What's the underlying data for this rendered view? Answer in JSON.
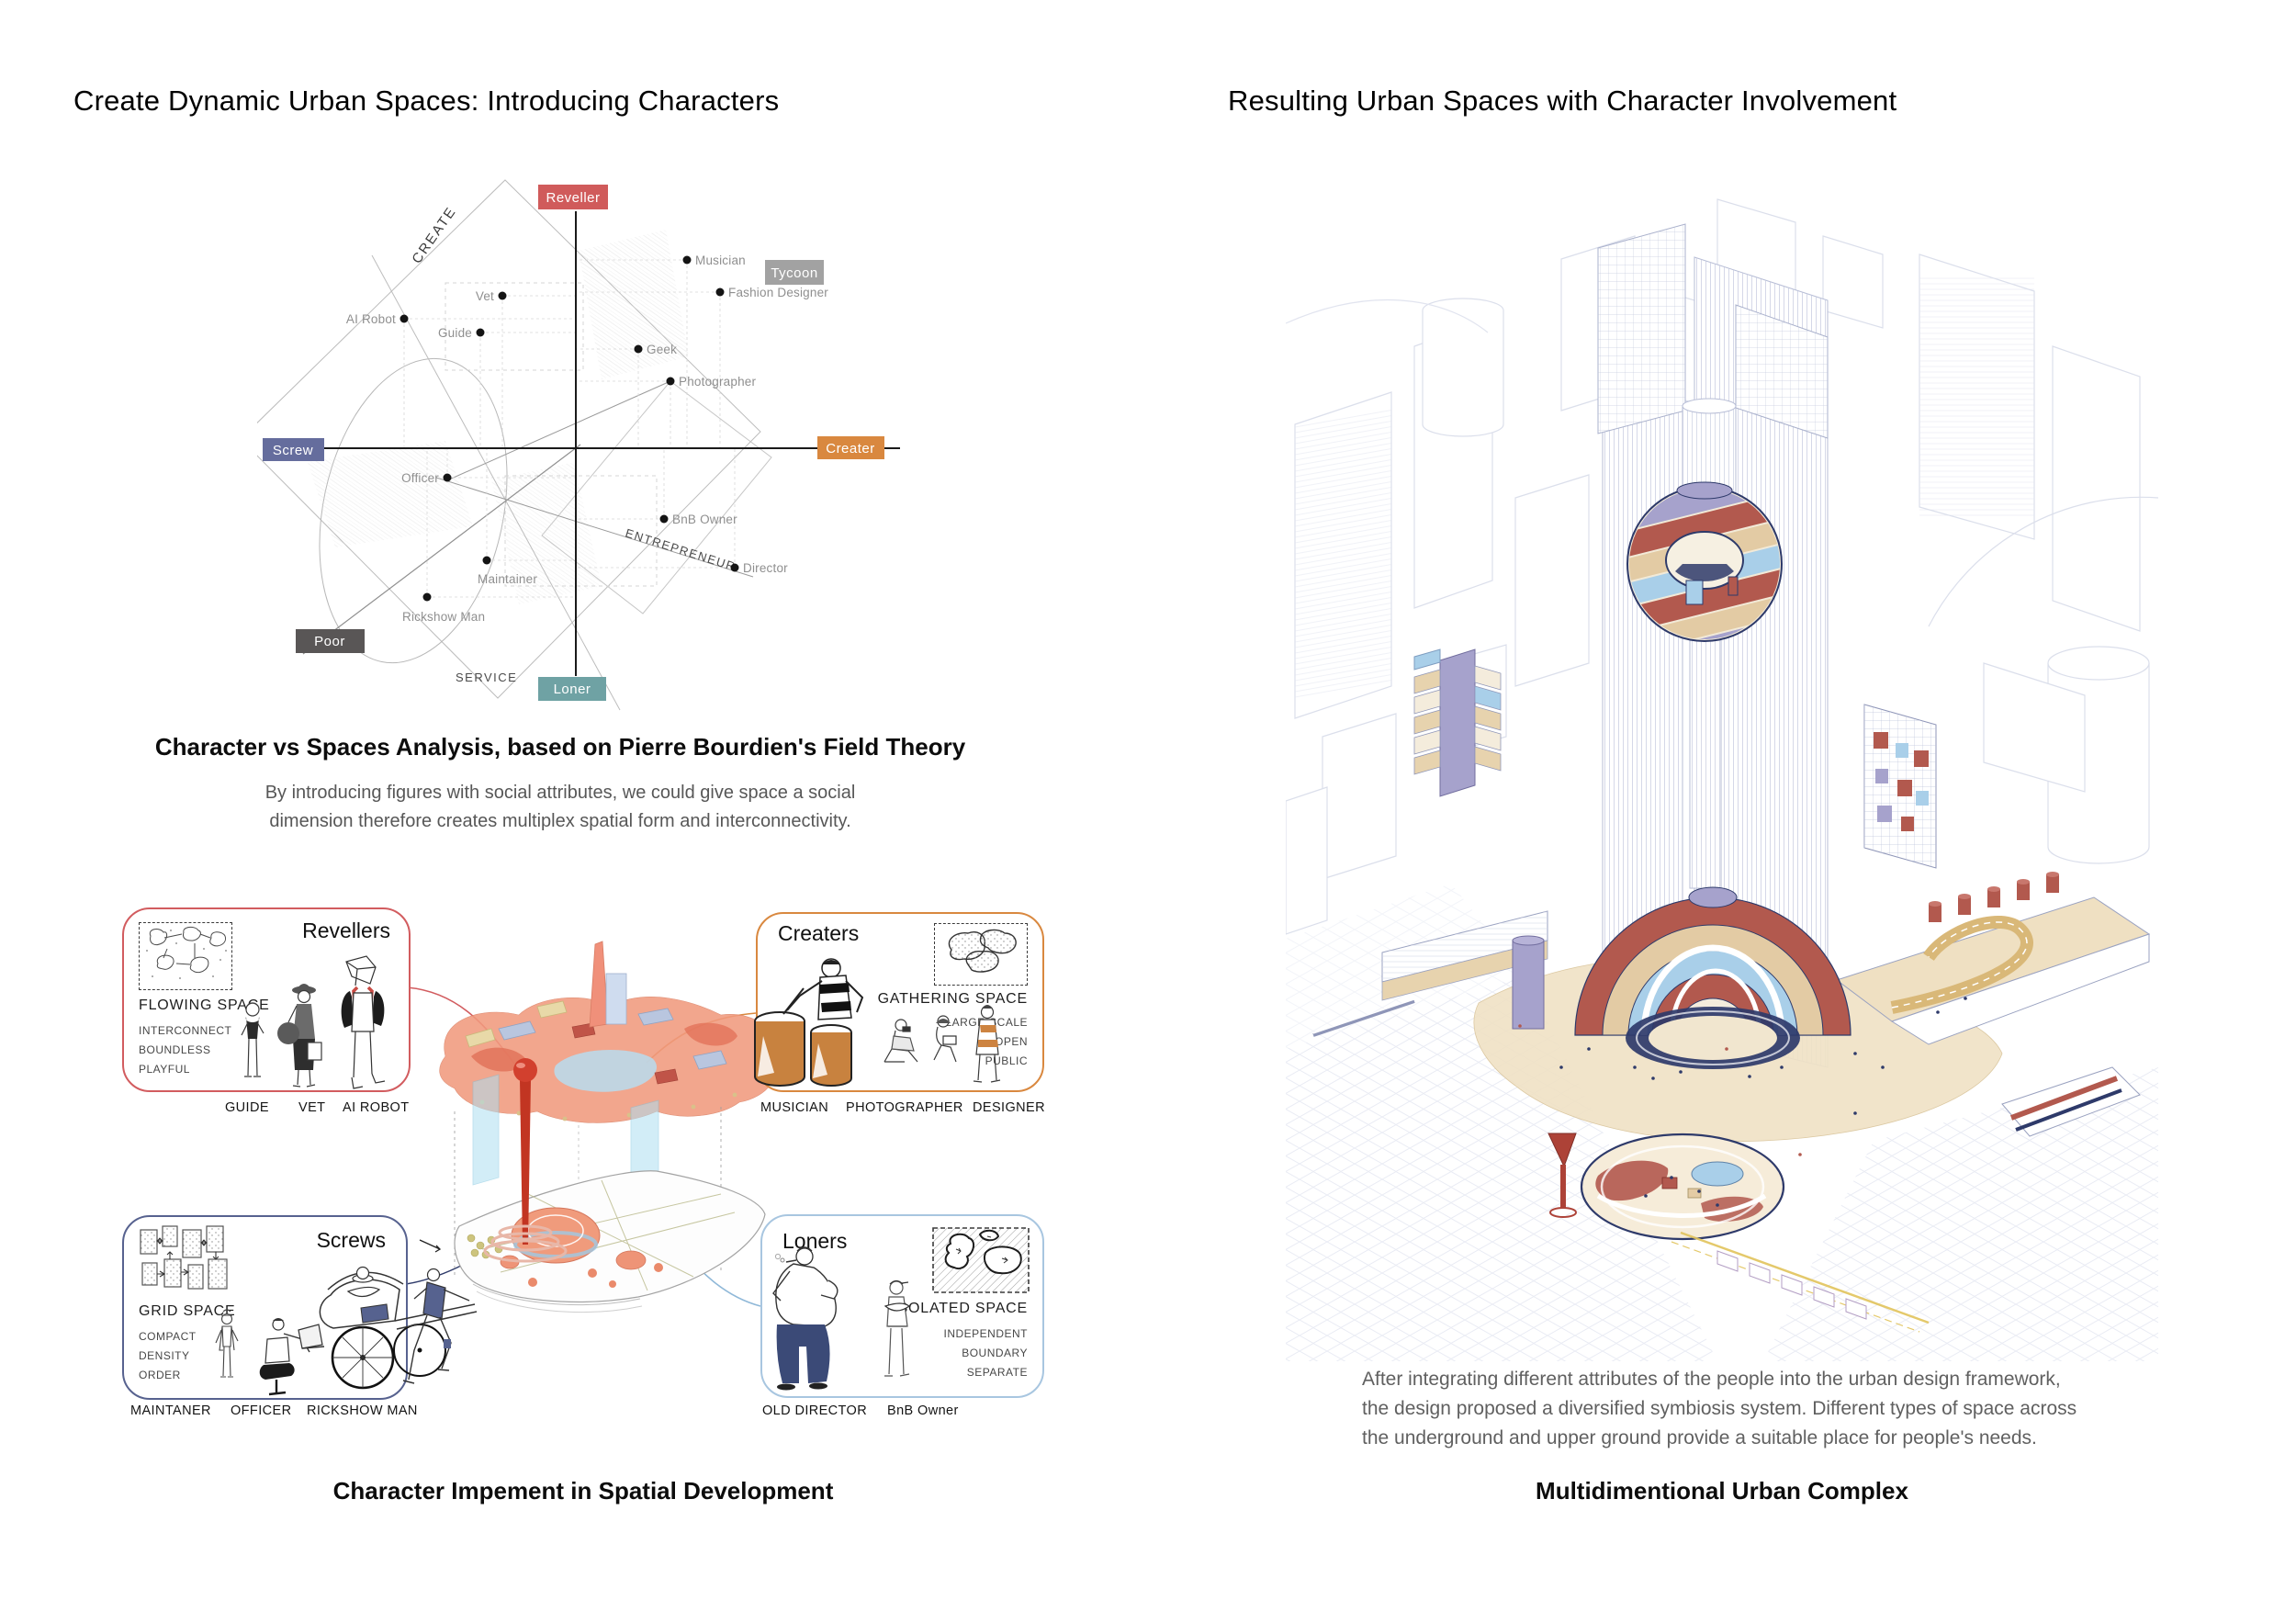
{
  "left": {
    "title": "Create Dynamic Urban Spaces: Introducing Characters",
    "diagram": {
      "poles": {
        "top": "Reveller",
        "right": "Creater",
        "bottom": "Loner",
        "left": "Screw",
        "top_right": "Tycoon",
        "bottom_left": "Poor"
      },
      "axes": {
        "create": "CREATE",
        "entrepreneur": "ENTREPRENEUR",
        "service": "SERVICE"
      }
    },
    "analysis": {
      "caption": "Character vs Spaces Analysis, based on Pierre Bourdien's Field Theory",
      "line1": "By introducing figures with social attributes, we could give space a social",
      "line2": "dimension therefore creates multiplex spatial form and interconnectivity."
    },
    "groups": [
      {
        "name": "Revellers",
        "space_type": "FLOWING SPACE",
        "attributes": [
          "INTERCONNECT",
          "BOUNDLESS",
          "PLAYFUL"
        ],
        "roles": [
          "GUIDE",
          "VET",
          "AI ROBOT"
        ],
        "border_color": "#d25c5f"
      },
      {
        "name": "Creaters",
        "space_type": "GATHERING SPACE",
        "attributes": [
          "LARGE-SCALE",
          "OPEN",
          "PUBLIC"
        ],
        "roles": [
          "MUSICIAN",
          "PHOTOGRAPHER",
          "DESIGNER"
        ],
        "border_color": "#d9883f"
      },
      {
        "name": "Screws",
        "space_type": "GRID SPACE",
        "attributes": [
          "COMPACT",
          "DENSITY",
          "ORDER"
        ],
        "roles": [
          "MAINTANER",
          "OFFICER",
          "RICKSHOW MAN"
        ],
        "border_color": "#57628f"
      },
      {
        "name": "Loners",
        "space_type": "ISOLATED SPACE",
        "attributes": [
          "INDEPENDENT",
          "BOUNDARY",
          "SEPARATE"
        ],
        "roles": [
          "OLD DIRECTOR",
          "BnB Owner"
        ],
        "border_color": "#a8c6e0"
      }
    ],
    "caption": "Character Impement in Spatial Development"
  },
  "right": {
    "title": "Resulting Urban Spaces with Character Involvement",
    "description": [
      "After integrating different attributes of the people into the urban design framework,",
      "the design proposed a diversified symbiosis system. Different types of space across",
      "the underground and upper ground provide a suitable place for people's needs."
    ],
    "caption": "Multidimentional Urban Complex"
  },
  "chart_data": {
    "type": "scatter",
    "title": "Character vs Spaces Analysis, based on Pierre Bourdien's Field Theory",
    "x_axis": {
      "left_pole": "Screw",
      "right_pole": "Creater"
    },
    "y_axis": {
      "top_pole": "Reveller",
      "bottom_pole": "Loner"
    },
    "corners": {
      "top_right": "Tycoon",
      "bottom_left": "Poor"
    },
    "diagonal_axis_labels": [
      "CREATE",
      "ENTREPRENEUR",
      "SERVICE"
    ],
    "points": [
      {
        "label": "Musician",
        "x": 0.34,
        "y": 0.68
      },
      {
        "label": "Fashion Designer",
        "x": 0.44,
        "y": 0.56
      },
      {
        "label": "Vet",
        "x": -0.23,
        "y": 0.55
      },
      {
        "label": "AI Robot",
        "x": -0.53,
        "y": 0.47
      },
      {
        "label": "Guide",
        "x": -0.29,
        "y": 0.42
      },
      {
        "label": "Geek",
        "x": 0.19,
        "y": 0.36
      },
      {
        "label": "Photographer",
        "x": 0.29,
        "y": 0.24
      },
      {
        "label": "Officer",
        "x": -0.39,
        "y": -0.11
      },
      {
        "label": "BnB Owner",
        "x": 0.27,
        "y": -0.26
      },
      {
        "label": "Maintainer",
        "x": -0.27,
        "y": -0.41
      },
      {
        "label": "Director",
        "x": 0.49,
        "y": -0.43
      },
      {
        "label": "Rickshow Man",
        "x": -0.46,
        "y": -0.54
      }
    ]
  },
  "palette": {
    "reveller_red": "#d25c5f",
    "creater_orange": "#d9883f",
    "screw_navy": "#57628f",
    "loner_box_teal": "#6fa2a4",
    "loner_border_blue": "#a8c6e0",
    "poor_gray": "#595656",
    "tycoon_gray": "#a2a2a2",
    "illustration_brick": "#b2594e",
    "illustration_tan": "#e3cba4",
    "illustration_blue": "#a9cfe9",
    "illustration_lavender": "#a6a2cc",
    "illustration_navy": "#2e3a6a",
    "faint_line": "#ccd1e3"
  }
}
